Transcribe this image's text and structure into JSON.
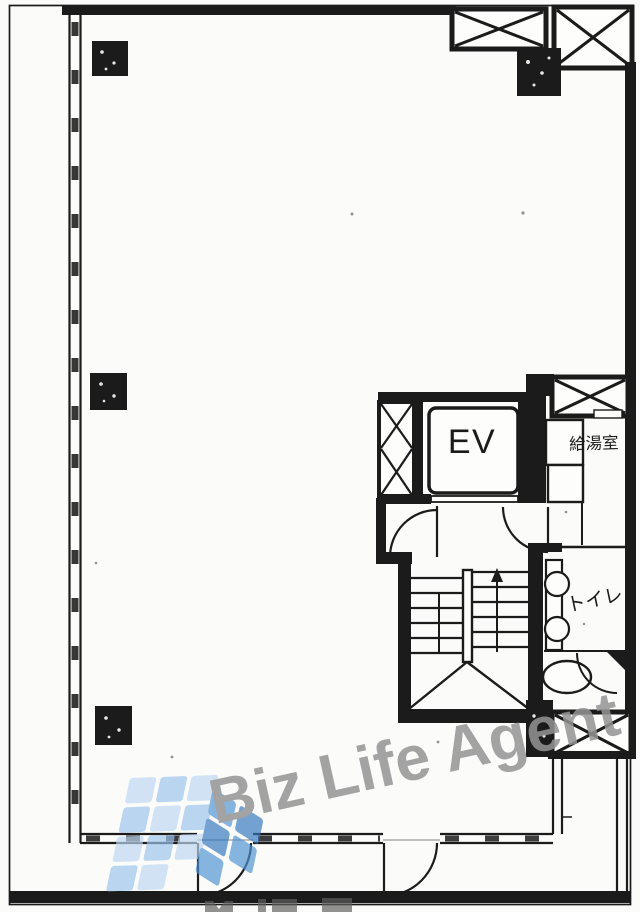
{
  "document": {
    "type": "scanned architectural floor plan",
    "background_color": "#fbfbfa",
    "ink_color": "#1b1b1b"
  },
  "rooms": {
    "elevator_label": "EV",
    "kitchenette_label": "給湯室",
    "toilet_label": "トイレ"
  },
  "features": {
    "staircase": "U-shaped stair with center rail, treads and winder landing",
    "shaft_boxes": "cross-hatched shaft/void boxes",
    "window_wall": "double-line window wall on left and bottom",
    "doors": "quarter-circle swing arcs"
  },
  "watermark": {
    "text": "Biz Life Agent",
    "text_color": "#949494",
    "logo": "building made of blue tiles",
    "logo_tile_colors": [
      "#bdd8f2",
      "#9cc4eb",
      "#4e93d4",
      "#3579bd"
    ]
  }
}
